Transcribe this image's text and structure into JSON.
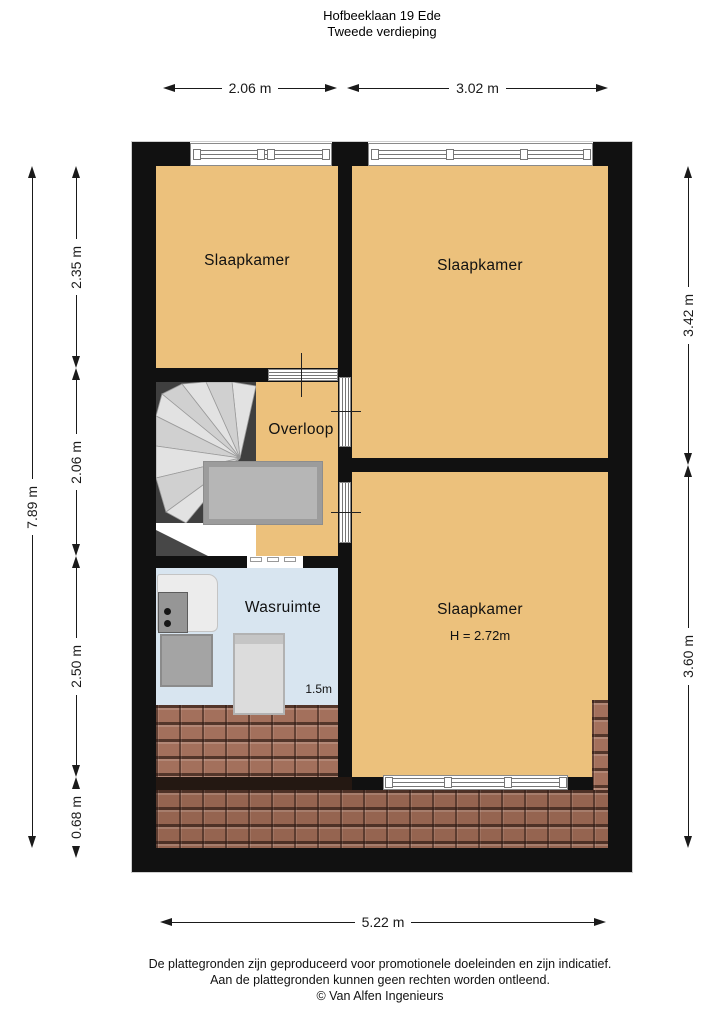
{
  "title": {
    "address": "Hofbeeklaan 19 Ede",
    "floor": "Tweede verdieping"
  },
  "dimensions": {
    "top": [
      "2.06 m",
      "3.02 m"
    ],
    "left_total": "7.89 m",
    "left": [
      "2.35 m",
      "2.06 m",
      "2.50 m",
      "0.68 m"
    ],
    "right": [
      "3.42 m",
      "3.60 m"
    ],
    "bottom": "5.22 m"
  },
  "rooms": {
    "bedroom_top_left": {
      "label": "Slaapkamer"
    },
    "bedroom_top_right": {
      "label": "Slaapkamer"
    },
    "landing": {
      "label": "Overloop"
    },
    "laundry": {
      "label": "Wasruimte",
      "height_marker": "1.5m"
    },
    "bedroom_bottom": {
      "label": "Slaapkamer",
      "ceiling_height": "H = 2.72m"
    }
  },
  "footer": {
    "line1": "De plattegronden zijn geproduceerd voor promotionele doeleinden en zijn indicatief.",
    "line2": "Aan de plattegronden kunnen geen rechten worden ontleend.",
    "line3": "© Van Alfen Ingenieurs"
  },
  "colors": {
    "floor": "#ecc17c",
    "laundry_floor": "#d8e5f0",
    "roof_tiles": "#a3705c",
    "walls": "#111111",
    "stairs_dark": "#3f3f3f"
  }
}
